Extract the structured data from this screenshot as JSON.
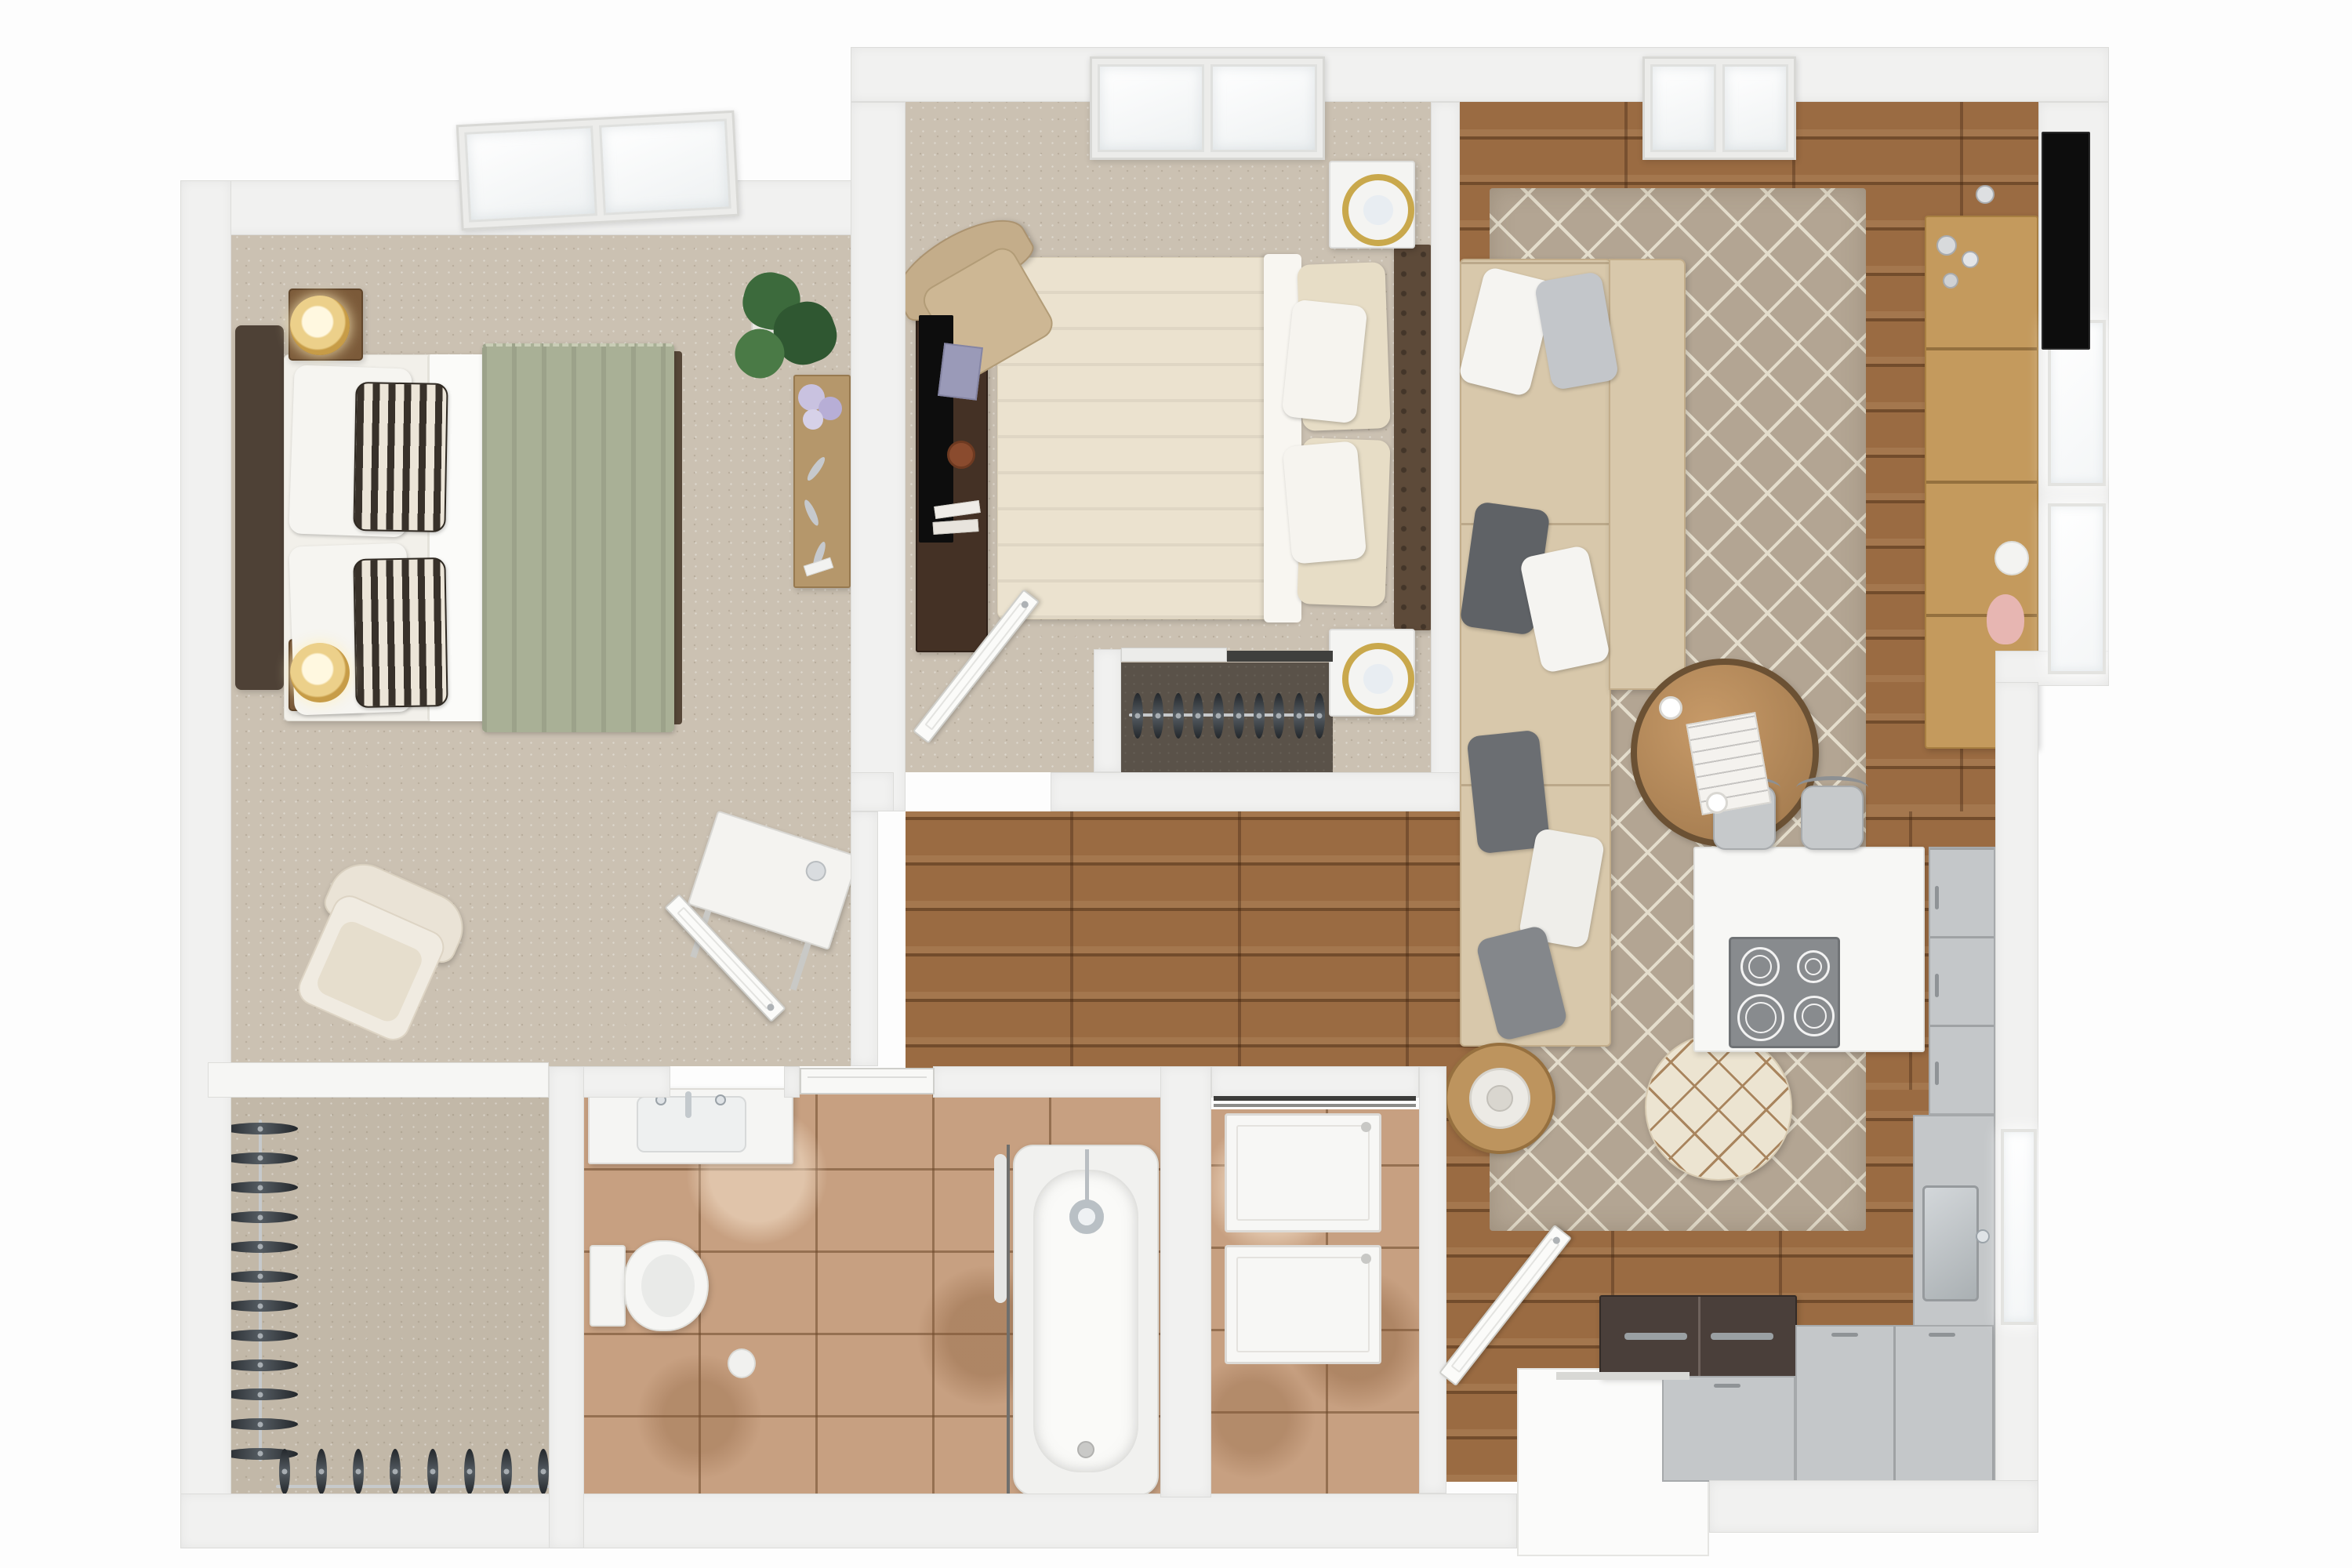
{
  "scene": {
    "type": "3d-floor-plan-top-view",
    "description": "Photorealistic top-down 3D rendering of a two-bedroom, one-bath apartment with living room, open kitchen, hallway, laundry closet and walk-in closet",
    "visible_text": "none"
  },
  "palette": {
    "outside": "#fdfdfd",
    "wall": "#f1f1f0",
    "wall_edge": "#dcdcda",
    "carpet": "#cbc1b2",
    "closet_carpet": "#5a5249",
    "wood": "#9a6b42",
    "tile": "#c7a081",
    "rug": "#b3a593",
    "rug_line": "#e4ddcc",
    "sofa": "#d8c8ab",
    "duvet_cream": "#ebe2cf",
    "blanket_sage": "#a9b096",
    "headboard_brown": "#5d4a39",
    "dark_wood": "#443125",
    "oak": "#c49a5d",
    "cabinet_gray": "#c4c7c9",
    "steel": "#b9bdc0",
    "tv_black": "#0d0d0d",
    "lamp_gold": "#c9a84c",
    "plant_green": "#3f6b3f",
    "accent_pink": "#e7b6b2"
  },
  "rooms": {
    "master_bedroom": {
      "label": "Master bedroom",
      "floor": "beige carpet"
    },
    "master_closet": {
      "label": "Walk-in closet",
      "floor": "beige carpet"
    },
    "bedroom_2": {
      "label": "Bedroom 2",
      "floor": "beige carpet"
    },
    "bedroom_2_closet": {
      "label": "Reach-in closet",
      "floor": "dark carpet"
    },
    "living_room": {
      "label": "Living room",
      "floor": "hardwood"
    },
    "hallway": {
      "label": "Hallway",
      "floor": "hardwood"
    },
    "kitchen": {
      "label": "Kitchen",
      "floor": "hardwood"
    },
    "bathroom": {
      "label": "Bathroom",
      "floor": "travertine tile"
    },
    "laundry_closet": {
      "label": "Laundry closet",
      "floor": "travertine tile"
    },
    "entry": {
      "label": "Entry",
      "floor": "hardwood"
    }
  },
  "furniture": {
    "master_bedroom": [
      "platform bed with dark headboard",
      "sage green throw blanket",
      "black and white striped pillows",
      "two wood nightstands",
      "two gold drum lamps",
      "monstera plant",
      "console table with hydrangeas",
      "cream armchair",
      "small white desk",
      "skylight"
    ],
    "bedroom_2": [
      "upholstered bed with tufted brown headboard",
      "cream duvet",
      "two white nightstands",
      "two gold ring lamps",
      "dark wood media console with TV",
      "tan wingback chair",
      "skylight"
    ],
    "living_room": [
      "beige L-shaped sectional sofa",
      "gray and white throw pillows",
      "diamond pattern area rug",
      "round wood coffee table",
      "round pouf with lattice stitching",
      "round side table",
      "oak media console",
      "wall TV",
      "two windows",
      "skylight"
    ],
    "kitchen": [
      "white peninsula island",
      "4-burner cooktop",
      "two gray bar stools",
      "gray cabinet run",
      "stainless sink",
      "window",
      "french-door refrigerator"
    ],
    "bathroom": [
      "white vanity with sink",
      "toilet",
      "toilet paper roll",
      "bathtub with handheld shower",
      "shower curtain rod",
      "pocket door"
    ],
    "laundry_closet": [
      "washer",
      "dryer"
    ],
    "closets": [
      "hanging rods with black hangers"
    ]
  },
  "counts": {
    "master_side_hangers": 12,
    "master_bottom_hangers": 8,
    "bedroom2_hangers": 10,
    "cooktop_burners": 4,
    "bar_stools": 2,
    "skylights": 3,
    "living_room_windows": 2,
    "kitchen_windows": 1,
    "open_doors": 3
  }
}
